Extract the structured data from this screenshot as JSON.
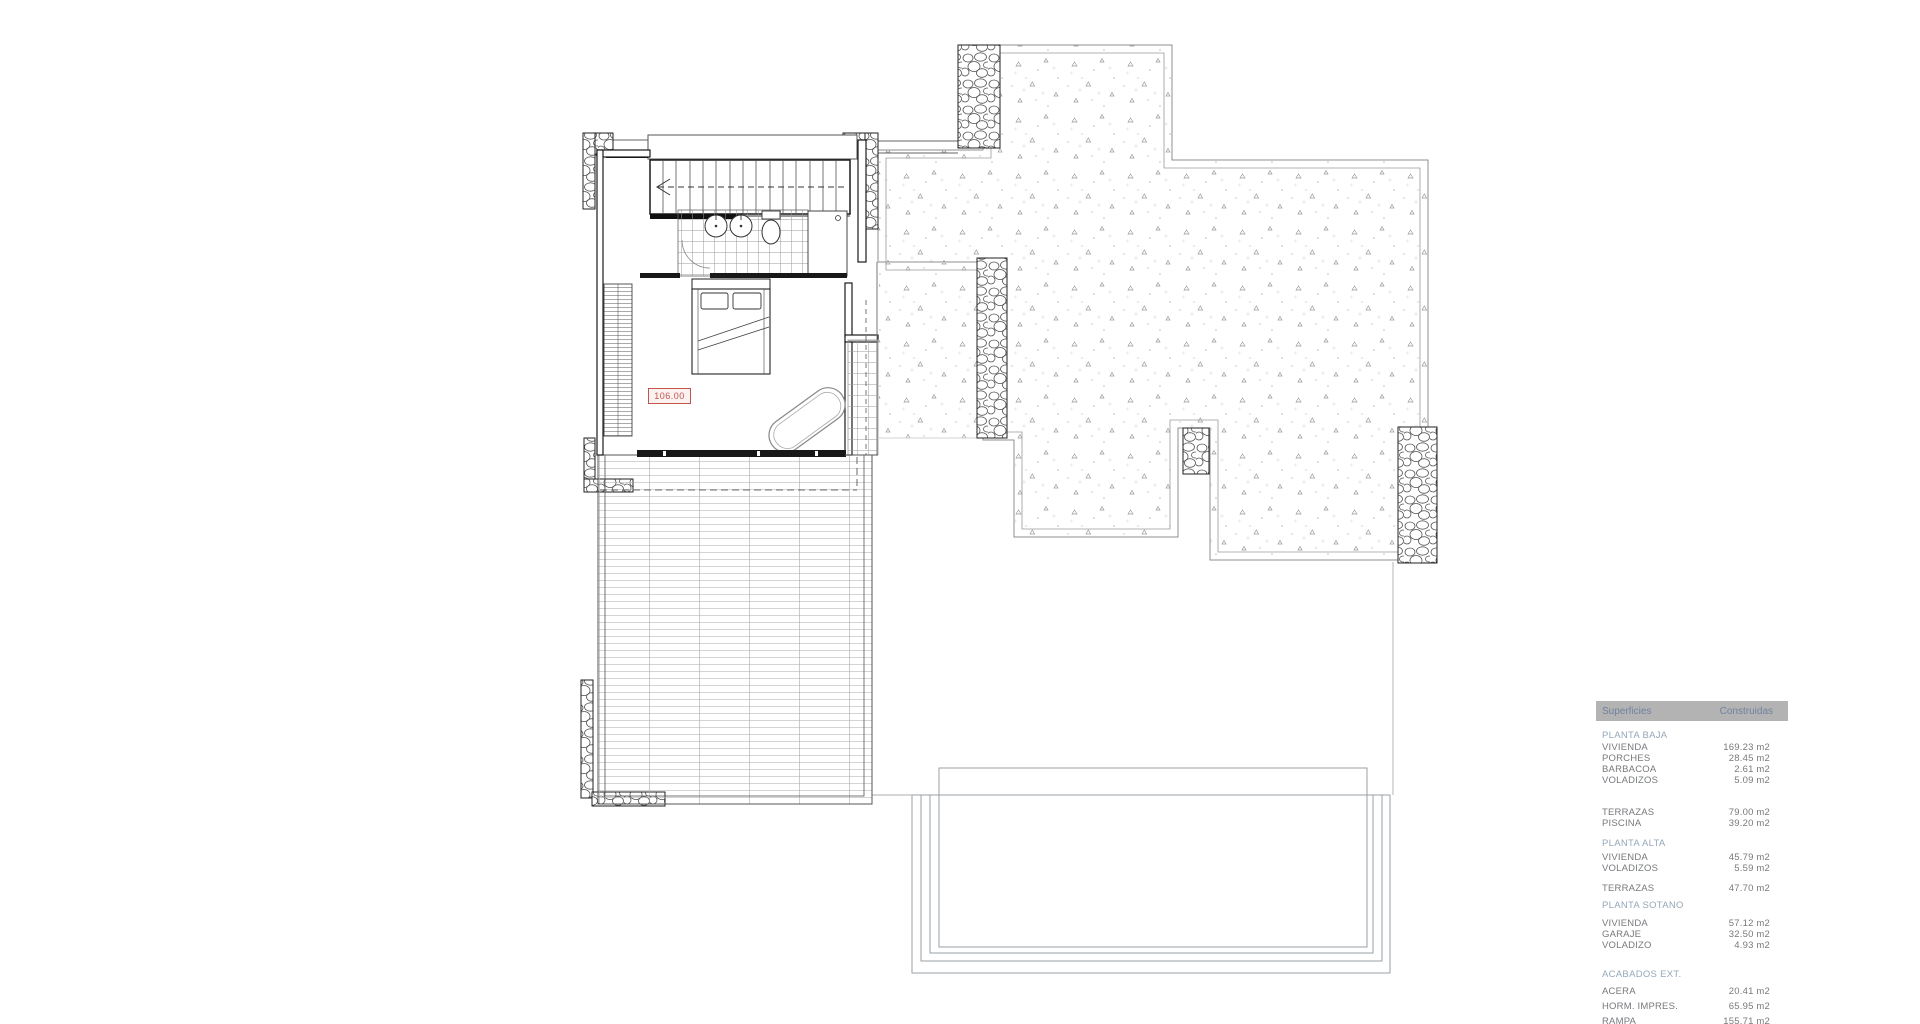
{
  "plan": {
    "room_area_label": "106.00"
  },
  "legend_table": {
    "header": {
      "surfaces": "Superficies",
      "built": "Construidas"
    },
    "sections": [
      {
        "title": "PLANTA BAJA",
        "rows": [
          {
            "label": "VIVIENDA",
            "value": "169.23 m2"
          },
          {
            "label": "PORCHES",
            "value": "28.45 m2"
          },
          {
            "label": "BARBACOA",
            "value": "2.61 m2"
          },
          {
            "label": "VOLADIZOS",
            "value": "5.09 m2"
          }
        ]
      },
      {
        "title": "",
        "rows": [
          {
            "label": "TERRAZAS",
            "value": "79.00 m2"
          },
          {
            "label": "PISCINA",
            "value": "39.20 m2"
          }
        ]
      },
      {
        "title": "PLANTA ALTA",
        "rows": [
          {
            "label": "VIVIENDA",
            "value": "45.79 m2"
          },
          {
            "label": "VOLADIZOS",
            "value": "5.59 m2"
          }
        ]
      },
      {
        "title": "",
        "rows": [
          {
            "label": "TERRAZAS",
            "value": "47.70 m2"
          }
        ]
      },
      {
        "title": "PLANTA SOTANO",
        "rows": [
          {
            "label": "VIVIENDA",
            "value": "57.12 m2"
          },
          {
            "label": "GARAJE",
            "value": "32.50 m2"
          },
          {
            "label": "VOLADIZO",
            "value": "4.93 m2"
          }
        ]
      },
      {
        "title": "ACABADOS EXT.",
        "rows": [
          {
            "label": "ACERA",
            "value": "20.41 m2"
          },
          {
            "label": "HORM. IMPRES.",
            "value": "65.95 m2"
          },
          {
            "label": "RAMPA",
            "value": "155.71 m2"
          }
        ]
      }
    ]
  },
  "colors": {
    "area_label": "#c4544e",
    "table_header_bg": "#b3b3b3",
    "table_header_text": "#6f82a0",
    "section_title": "#95a8b9",
    "row_text": "#77797c",
    "wall_line": "#1a1a1a"
  }
}
